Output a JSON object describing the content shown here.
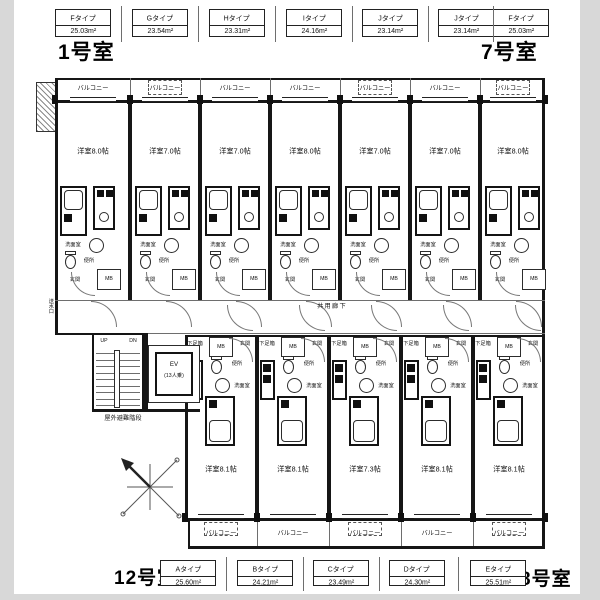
{
  "page_titles": {
    "top_left": "1号室",
    "top_right": "7号室",
    "bottom_left": "12号室",
    "bottom_right": "8号室"
  },
  "top_type_labels": [
    {
      "name": "Fタイプ",
      "area": "25.03m²"
    },
    {
      "name": "Gタイプ",
      "area": "23.54m²"
    },
    {
      "name": "Hタイプ",
      "area": "23.31m²"
    },
    {
      "name": "Iタイプ",
      "area": "24.16m²"
    },
    {
      "name": "Jタイプ",
      "area": "23.14m²"
    },
    {
      "name": "Jタイプ",
      "area": "23.14m²"
    },
    {
      "name": "Fタイプ",
      "area": "25.03m²"
    }
  ],
  "bottom_type_labels": [
    {
      "name": "Aタイプ",
      "area": "25.60m²"
    },
    {
      "name": "Bタイプ",
      "area": "24.21m²"
    },
    {
      "name": "Cタイプ",
      "area": "23.49m²"
    },
    {
      "name": "Dタイプ",
      "area": "24.30m²"
    },
    {
      "name": "Eタイプ",
      "area": "25.51m²"
    }
  ],
  "upper_units": [
    {
      "room": "洋室8.0帖",
      "ac_on_balcony": false
    },
    {
      "room": "洋室7.0帖",
      "ac_on_balcony": true
    },
    {
      "room": "洋室7.0帖",
      "ac_on_balcony": false
    },
    {
      "room": "洋室8.0帖",
      "ac_on_balcony": false
    },
    {
      "room": "洋室7.0帖",
      "ac_on_balcony": true
    },
    {
      "room": "洋室7.0帖",
      "ac_on_balcony": false
    },
    {
      "room": "洋室8.0帖",
      "ac_on_balcony": true
    }
  ],
  "lower_units": [
    {
      "room": "洋室8.1帖",
      "ac_on_balcony": true
    },
    {
      "room": "洋室8.1帖",
      "ac_on_balcony": false
    },
    {
      "room": "洋室7.3帖",
      "ac_on_balcony": true
    },
    {
      "room": "洋室8.1帖",
      "ac_on_balcony": false
    },
    {
      "room": "洋室8.1帖",
      "ac_on_balcony": true
    }
  ],
  "labels": {
    "balcony": "バルコニー",
    "shared_corridor": "共用廊下",
    "corridor": "廊下",
    "entrance": "玄関",
    "washroom": "洗面室",
    "toilet": "便所",
    "meter_box": "MB",
    "shoe_box": "下足箱",
    "up": "UP",
    "down": "DN",
    "outdoor_stairs": "屋外避難階段",
    "elevator": "EV",
    "elevator_capacity": "(13人乗)",
    "standpipe": "送水口"
  }
}
